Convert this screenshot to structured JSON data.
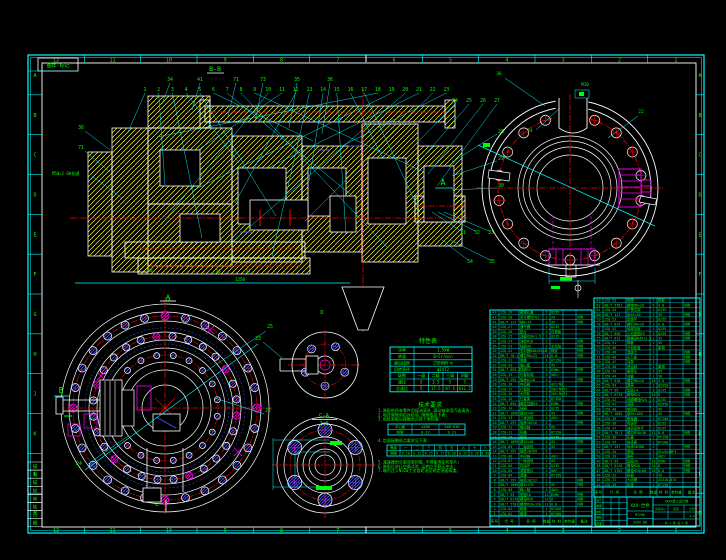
{
  "colors": {
    "cyan": "#00ffff",
    "green": "#00ff00",
    "white": "#ffffff",
    "red": "#ff0000",
    "yellow": "#ffff00",
    "magenta": "#ff00ff",
    "blue": "#4455ff",
    "bg": "#000000"
  },
  "frame": {
    "corner_label": "图样·标记",
    "zone_numbers_top": [
      "12",
      "11",
      "10",
      "9",
      "8",
      "7",
      "6",
      "5",
      "4",
      "3",
      "2",
      "1"
    ],
    "zone_numbers_bottom": [
      "12",
      "11",
      "10",
      "9",
      "8",
      "7",
      "6",
      "5",
      "4",
      "3",
      "2",
      "1"
    ],
    "zone_letters_left": [
      "A",
      "B",
      "C",
      "D",
      "E",
      "F",
      "G",
      "H",
      "J",
      "K",
      "L",
      "M"
    ],
    "zone_letters_right": [
      "A",
      "B",
      "C",
      "D",
      "E",
      "F",
      "G",
      "H",
      "J",
      "K",
      "L",
      "M"
    ],
    "binding_strip": [
      "描",
      "图",
      "描",
      "校",
      "审",
      "核",
      "日",
      "期"
    ]
  },
  "section_view": {
    "section_label": "B-B",
    "view_label": "A",
    "spline_note": "M50×2-6H花键",
    "callouts_top": [
      "1",
      "2",
      "3",
      "4",
      "5",
      "6",
      "7",
      "8",
      "9",
      "10",
      "11",
      "12",
      "13",
      "14",
      "15",
      "16",
      "17",
      "18",
      "19",
      "20",
      "21",
      "22",
      "23"
    ],
    "callouts_upper": [
      "34",
      "41",
      "71",
      "73",
      "35",
      "36"
    ],
    "callouts_right_row": [
      "24",
      "25",
      "26",
      "27"
    ],
    "callouts_right_col": [
      "28",
      "29",
      "30"
    ],
    "callouts_right_low": [
      "31",
      "32",
      "33"
    ],
    "callouts_right_low2": [
      "34",
      "35"
    ],
    "callouts_left": [
      "36",
      "71"
    ],
    "misc_labels": [
      "40",
      "36",
      "37",
      "1250"
    ]
  },
  "flange_view": {
    "dir_label": "A",
    "top_note": "M10",
    "callout_36": "36",
    "callout_22": "22",
    "callout_24": "24"
  },
  "big_circle_view": {
    "dir_label": "B",
    "cut_label": "C",
    "top_label": "14",
    "callout_25": "25",
    "callout_22": "22",
    "callout_24": "24"
  },
  "small_views": {
    "top_label": "D",
    "handle_callout": "23",
    "detail_title": "C-A",
    "detail_scale": "2:1"
  },
  "char_table": {
    "title": "特性表",
    "rows": [
      [
        "功率",
        "1.5kW"
      ],
      [
        "转速",
        "0~5r/min"
      ],
      [
        "输出扭矩",
        "25000N·m"
      ],
      [
        "回转直径",
        "φ1472"
      ]
    ],
    "grid_header": [
      "级数",
      "一级",
      "二级",
      "三级",
      "四级"
    ],
    "grid_rows": [
      [
        "速比",
        "5",
        "3.5",
        "5",
        "7"
      ],
      [
        "总速比",
        "5",
        "17.5",
        "87.5",
        "612.5"
      ]
    ]
  },
  "tech_notes": {
    "title": "技术要求",
    "lines_before": [
      "1.装配前所有零件用煤油清洗,滚动轴承用汽油清洗;",
      "2.啮合侧隙用铅丝检验,侧隙值见下表;",
      "3.齿轮装配后接触斑点按下表检查:"
    ],
    "table1_rows": [
      [
        "中心距",
        "≤500",
        "500~630"
      ],
      [
        "侧隙",
        "0.17",
        "0.21"
      ]
    ],
    "line4": "4.齿面接触斑点要求见下表:",
    "table2_rows": [
      [
        "等级",
        "一",
        "二",
        "三",
        "四",
        "五",
        "六",
        "七",
        "八"
      ],
      [
        "侧隙",
        "0.10",
        "0.12",
        "0.15",
        "0.17",
        "0.20",
        "0.22",
        "0.26",
        "0.30"
      ]
    ],
    "lines_after": [
      "5.减速器剖分面涂密封胶,不得使用任何垫片;",
      "6.装配后进行空载试验,运转应平稳无冲击;",
      "7.箱内注入N320工业齿轮油至规定油面高度。"
    ]
  },
  "bom": {
    "headers": [
      "序号",
      "代  号",
      "名  称",
      "数量",
      "材  料",
      "单件重",
      "备注"
    ],
    "left_rows": [
      [
        "1",
        "JZQ-01",
        "箱体",
        "1",
        "HT200",
        "",
        ""
      ],
      [
        "2",
        "JZQ-02",
        "箱盖",
        "1",
        "HT200",
        "",
        ""
      ],
      [
        "3",
        "GB/T 5782",
        "螺栓M16×120",
        "12",
        "8.8",
        "",
        "外购"
      ],
      [
        "4",
        "GB/T 6170",
        "螺母M16",
        "12",
        "8",
        "",
        "外购"
      ],
      [
        "5",
        "GB/T 93",
        "垫圈16",
        "12",
        "65Mn",
        "",
        "外购"
      ],
      [
        "6",
        "JZQ-03",
        "输入轴",
        "1",
        "40Cr",
        "",
        ""
      ],
      [
        "7",
        "GB/T 1096",
        "键12×70",
        "1",
        "45",
        "",
        "外购"
      ],
      [
        "8",
        "GB/T 297",
        "轴承30212",
        "2",
        "",
        "",
        "外购"
      ],
      [
        "9",
        "JZQ-04",
        "透盖",
        "1",
        "HT150",
        "",
        ""
      ],
      [
        "10",
        "JZQ-05",
        "调整垫片",
        "2",
        "08F",
        "",
        ""
      ],
      [
        "11",
        "JZQ-06",
        "挡油环",
        "2",
        "Q235",
        "",
        ""
      ],
      [
        "12",
        "JZQ-07",
        "一级齿轮",
        "1",
        "45",
        "",
        ""
      ],
      [
        "13",
        "JZQ-08",
        "中间轴",
        "1",
        "40Cr",
        "",
        ""
      ],
      [
        "14",
        "GB/T 297",
        "轴承30209",
        "2",
        "",
        "",
        "外购"
      ],
      [
        "15",
        "JZQ-09",
        "二级齿轮",
        "1",
        "45",
        "",
        ""
      ],
      [
        "16",
        "GB/T 1096",
        "键10×56",
        "1",
        "45",
        "",
        "外购"
      ],
      [
        "17",
        "JZQ-10",
        "套筒",
        "1",
        "Q235",
        "",
        ""
      ],
      [
        "18",
        "JZQ-11",
        "闷盖",
        "1",
        "HT150",
        "",
        ""
      ],
      [
        "19",
        "JZQ-12",
        "输出轴",
        "1",
        "45",
        "",
        ""
      ],
      [
        "20",
        "GB/T 297",
        "轴承30216",
        "2",
        "",
        "",
        "外购"
      ],
      [
        "21",
        "JZQ-13",
        "三级齿轮",
        "1",
        "40Cr",
        "",
        ""
      ],
      [
        "22",
        "GB/T 1096",
        "键16×90",
        "1",
        "45",
        "",
        "外购"
      ],
      [
        "23",
        "JZQ-14",
        "挡圈",
        "2",
        "Q235",
        "",
        ""
      ],
      [
        "24",
        "GB/T 894.1",
        "弹性挡圈45",
        "1",
        "65Mn",
        "",
        "外购"
      ],
      [
        "25",
        "JZQ-15",
        "行星架",
        "1",
        "QT450",
        "",
        ""
      ],
      [
        "26",
        "JZQ-16",
        "太阳轮",
        "1",
        "20CrMnTi",
        "",
        ""
      ],
      [
        "27",
        "JZQ-17",
        "行星轮",
        "3",
        "20CrMnTi",
        "",
        ""
      ],
      [
        "28",
        "JZQ-18",
        "内齿圈",
        "1",
        "42CrMo",
        "",
        ""
      ],
      [
        "29",
        "GB/T 292",
        "轴承6210",
        "3",
        "",
        "",
        "外购"
      ],
      [
        "30",
        "JZQ-19",
        "行星轮轴",
        "3",
        "40Cr",
        "",
        ""
      ],
      [
        "31",
        "GB/T 893.1",
        "挡圈52",
        "3",
        "65Mn",
        "",
        "外购"
      ],
      [
        "32",
        "JZQ-20",
        "偏心套",
        "1",
        "45",
        "",
        ""
      ],
      [
        "33",
        "JZQ-21",
        "端盖",
        "1",
        "HT150",
        "",
        ""
      ],
      [
        "34",
        "GB/T 70.1",
        "螺钉M8×25",
        "24",
        "8.8",
        "",
        "外购"
      ],
      [
        "35",
        "JZQ-22",
        "密封圈B40×62×8",
        "2",
        "橡胶",
        "",
        "外购"
      ],
      [
        "36",
        "JZQ-23",
        "毡圈40",
        "2",
        "羊毛毡",
        "",
        "外购"
      ],
      [
        "37",
        "JZQ-24",
        "油标M16",
        "1",
        "",
        "",
        "外购"
      ],
      [
        "38",
        "JZQ-25",
        "油塞M20×1.5",
        "1",
        "Q235",
        "",
        ""
      ],
      [
        "39",
        "JZQ-26",
        "垫片",
        "1",
        "石棉板",
        "",
        ""
      ],
      [
        "40",
        "JZQ-27",
        "通气器",
        "1",
        "Q235",
        "",
        ""
      ],
      [
        "41",
        "GB/T 117",
        "销8×35",
        "2",
        "35",
        "",
        "外购"
      ],
      [
        "42",
        "JZQ-28",
        "吊环螺钉M12",
        "2",
        "20",
        "",
        "外购"
      ],
      [
        "43",
        "JZQ-29",
        "窥视孔盖",
        "1",
        "Q235",
        "",
        ""
      ]
    ],
    "right_rows": [
      [
        "44",
        "JZQ-30",
        "机座",
        "1",
        "HT250",
        "",
        ""
      ],
      [
        "45",
        "JZQ-31",
        "大齿圈",
        "1",
        "ZG310-570",
        "",
        ""
      ],
      [
        "46",
        "JZQ-32",
        "轮毂",
        "1",
        "45",
        "",
        ""
      ],
      [
        "47",
        "GB/T 5782",
        "螺栓M20×80",
        "16",
        "8.8",
        "",
        "外购"
      ],
      [
        "48",
        "GB/T 6170",
        "螺母M20",
        "16",
        "8",
        "",
        "外购"
      ],
      [
        "49",
        "GB/T 93",
        "垫圈20",
        "16",
        "65Mn",
        "",
        "外购"
      ],
      [
        "50",
        "JZQ-33",
        "蜗杆",
        "1",
        "40Cr",
        "",
        ""
      ],
      [
        "51",
        "JZQ-34",
        "蜗轮",
        "1",
        "ZCuSn10P1",
        "",
        ""
      ],
      [
        "52",
        "GB/T 297",
        "轴承30308",
        "2",
        "",
        "",
        "外购"
      ],
      [
        "53",
        "JZQ-35",
        "轴承座",
        "2",
        "HT200",
        "",
        ""
      ],
      [
        "54",
        "JZQ-36",
        "压盖",
        "2",
        "HT150",
        "",
        ""
      ],
      [
        "55",
        "GB/T 70.1",
        "螺钉M10×30",
        "12",
        "8.8",
        "",
        "外购"
      ],
      [
        "56",
        "JZQ-37",
        "迷宫密封环",
        "2",
        "Q235",
        "",
        ""
      ],
      [
        "57",
        "JZQ-38",
        "甩油环",
        "1",
        "Q235",
        "",
        ""
      ],
      [
        "58",
        "JZQ-39",
        "联轴器",
        "1",
        "HT200",
        "",
        ""
      ],
      [
        "59",
        "GB/T 1096",
        "键20×100",
        "1",
        "45",
        "",
        "外购"
      ],
      [
        "60",
        "JZQ-40",
        "制动轮",
        "1",
        "45",
        "",
        ""
      ],
      [
        "61",
        "JZQ-41",
        "底座",
        "1",
        "Q235A",
        "",
        ""
      ],
      [
        "62",
        "JZQ-42",
        "地脚螺栓M24",
        "8",
        "Q235",
        "",
        ""
      ],
      [
        "63",
        "GB/T 6170",
        "螺母M24",
        "16",
        "8",
        "",
        "外购"
      ],
      [
        "64",
        "GB/T 95",
        "垫圈24",
        "8",
        "Q235",
        "",
        "外购"
      ],
      [
        "65",
        "JZQ-43",
        "罩壳",
        "1",
        "Q235A",
        "",
        ""
      ],
      [
        "66",
        "GB/T 818",
        "螺钉M6×16",
        "18",
        "4.8",
        "",
        "外购"
      ],
      [
        "67",
        "JZQ-44",
        "油管",
        "1",
        "10",
        "",
        ""
      ],
      [
        "68",
        "JZQ-45",
        "管接头",
        "2",
        "35",
        "",
        ""
      ],
      [
        "69",
        "JZQ-46",
        "滤油网",
        "1",
        "黄铜",
        "",
        ""
      ],
      [
        "70",
        "JZQ-47",
        "油泵",
        "1",
        "",
        "",
        "外购"
      ],
      [
        "71",
        "JZQ-48",
        "压力表",
        "1",
        "",
        "",
        "外购"
      ],
      [
        "72",
        "JZQ-49",
        "温度计",
        "1",
        "",
        "",
        "外购"
      ],
      [
        "73",
        "JZQ-50",
        "冷却蛇管",
        "1",
        "紫铜",
        "",
        ""
      ],
      [
        "74",
        "JZQ-51",
        "隔套",
        "2",
        "45",
        "",
        ""
      ],
      [
        "75",
        "GB/T 812",
        "圆螺母M45×1.5",
        "2",
        "35",
        "",
        "外购"
      ],
      [
        "76",
        "GB/T 858",
        "止动垫圈45",
        "2",
        "Q235",
        "",
        "外购"
      ],
      [
        "77",
        "JZQ-52",
        "轴端挡板",
        "1",
        "Q235",
        "",
        ""
      ],
      [
        "78",
        "GB/T 819",
        "螺钉M6×20",
        "3",
        "4.8",
        "",
        "外购"
      ],
      [
        "79",
        "JZQ-53",
        "定距环",
        "2",
        "Q235",
        "",
        ""
      ],
      [
        "80",
        "GB/T 117",
        "销10×50",
        "2",
        "35",
        "",
        "外购"
      ],
      [
        "81",
        "JZQ-54",
        "护罩支架",
        "2",
        "Q235",
        "",
        ""
      ],
      [
        "82",
        "GB/T 5781",
        "螺栓M8×20",
        "6",
        "4.8",
        "",
        "外购"
      ],
      [
        "83",
        "JZQ-55",
        "铭牌",
        "1",
        "铝板",
        "",
        ""
      ]
    ]
  },
  "title_block": {
    "name": "XXX-合件",
    "org": "XXXX重工设计院",
    "rows_left": [
      "设计",
      "制图",
      "校核",
      "审核",
      "批准"
    ],
    "material": "HT200",
    "code": "XXXX-00",
    "stage_label": "阶段标记",
    "mass_label": "质量",
    "scale_label": "比例",
    "scale": "1:2",
    "sheets": "共 1 张 第 1 张"
  }
}
